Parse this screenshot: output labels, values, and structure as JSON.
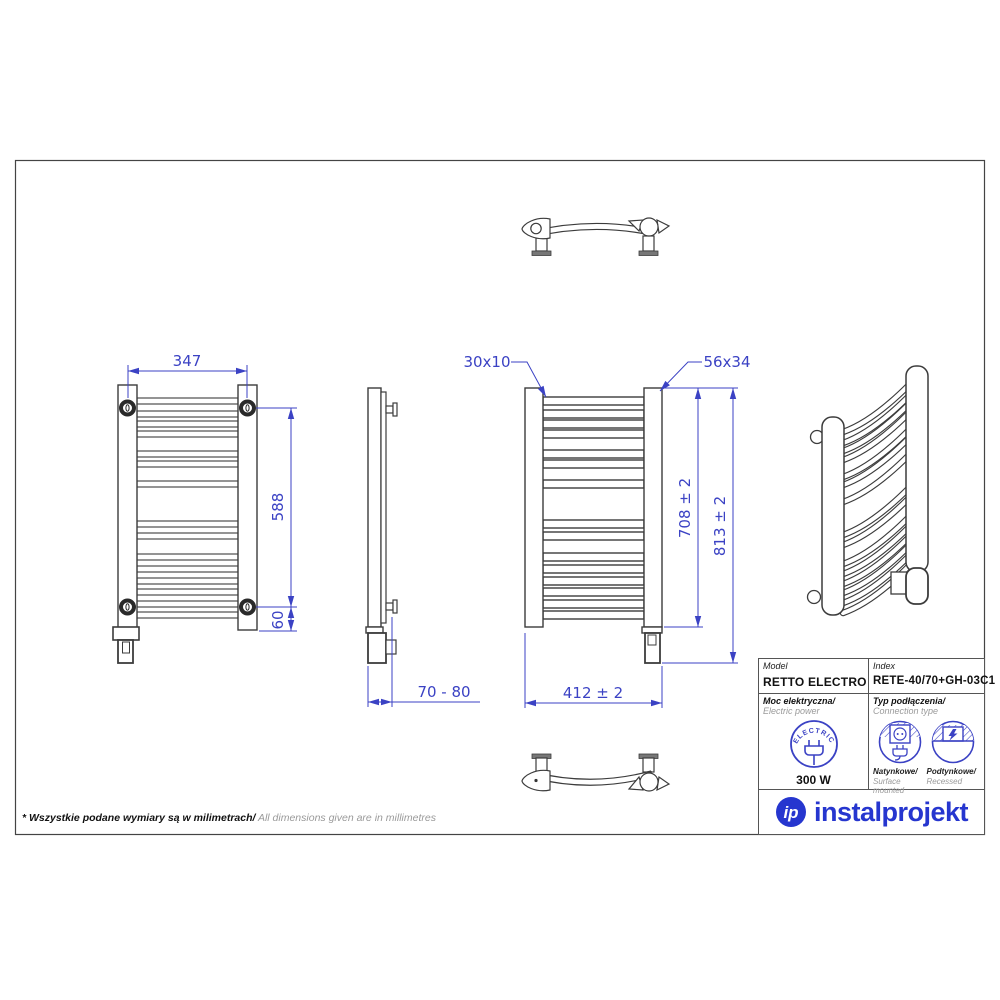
{
  "dims": {
    "front_width": "347",
    "front_screw_span": "588",
    "front_bottom_offset": "60",
    "wall_distance": "70 - 80",
    "profile_size": "30x10",
    "tube_size": "56x34",
    "back_width": "412 ± 2",
    "back_height": "708 ± 2",
    "total_height": "813 ± 2"
  },
  "title_block": {
    "model_label": "Model",
    "model_value": "RETTO ELECTRO",
    "index_label": "Index",
    "index_value": "RETE-40/70+GH-03C1",
    "power_label_pl": "Moc elektryczna/",
    "power_label_en": " Electric power",
    "electric_badge": "ELECTRIC",
    "power_value": "300 W",
    "connection_label_pl": "Typ podłączenia/",
    "connection_label_en": "Connection type",
    "surface_pl": "Natynkowe/",
    "surface_en": "Surface mounted",
    "recessed_pl": "Podtynkowe/",
    "recessed_en": "Recessed",
    "logo_monogram": "ip",
    "brand": "instalprojekt"
  },
  "footnote": {
    "pl": "* Wszystkie podane wymiary są w milimetrach/",
    "en": " All dimensions given are in millimetres"
  },
  "colors": {
    "dimension_blue": "#3b42c4",
    "line_dark": "#3c3c3c",
    "brand_blue": "#2636cf",
    "muted_gray": "#9a9a9a"
  }
}
